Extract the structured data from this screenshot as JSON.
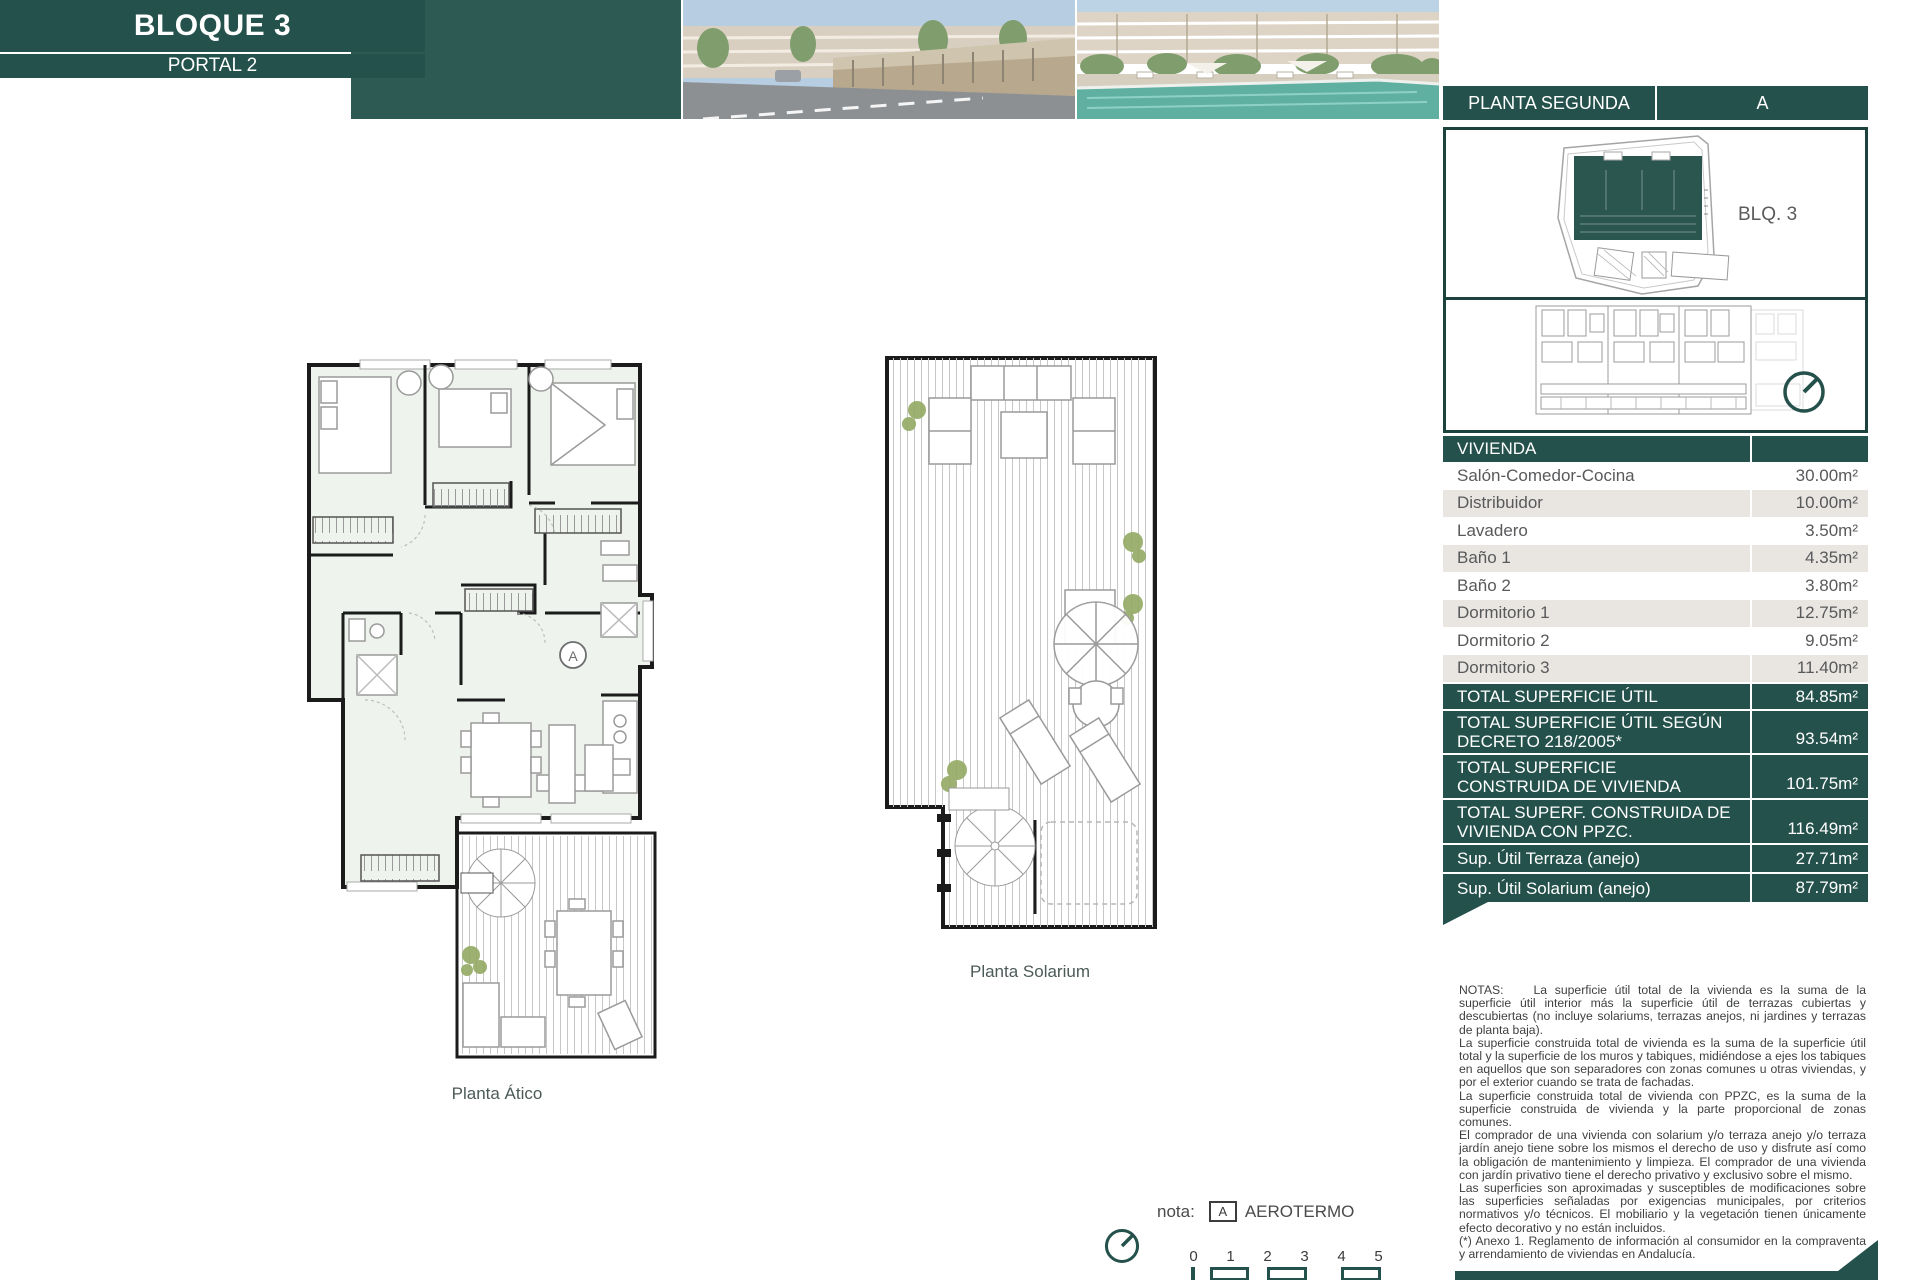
{
  "header": {
    "bloque": "BLOQUE 3",
    "portal": "PORTAL 2",
    "planta": "PLANTA SEGUNDA",
    "unit": "A"
  },
  "site_plan": {
    "block_label": "BLQ. 3"
  },
  "table": {
    "section_title": "VIVIENDA",
    "rows": [
      {
        "label": "Salón-Comedor-Cocina",
        "value": "30.00m²"
      },
      {
        "label": "Distribuidor",
        "value": "10.00m²"
      },
      {
        "label": "Lavadero",
        "value": "3.50m²"
      },
      {
        "label": "Baño 1",
        "value": "4.35m²"
      },
      {
        "label": "Baño 2",
        "value": "3.80m²"
      },
      {
        "label": "Dormitorio 1",
        "value": "12.75m²"
      },
      {
        "label": "Dormitorio 2",
        "value": "9.05m²"
      },
      {
        "label": "Dormitorio 3",
        "value": "11.40m²"
      }
    ],
    "totals": [
      {
        "label": "TOTAL SUPERFICIE ÚTIL",
        "value": "84.85m²"
      },
      {
        "label": "TOTAL SUPERFICIE ÚTIL SEGÚN\nDECRETO 218/2005*",
        "value": "93.54m²"
      },
      {
        "label": "TOTAL SUPERFICIE\nCONSTRUIDA DE VIVIENDA",
        "value": "101.75m²"
      },
      {
        "label": "TOTAL SUPERF. CONSTRUIDA DE\nVIVIENDA CON PPZC.",
        "value": "116.49m²"
      },
      {
        "label": "Sup. Útil Terraza (anejo)",
        "value": "27.71m²"
      },
      {
        "label": "Sup. Útil Solarium (anejo)",
        "value": "87.79m²"
      }
    ]
  },
  "plans": {
    "atico_label": "Planta Ático",
    "solarium_label": "Planta Solarium",
    "marker": "A"
  },
  "legend": {
    "nota_label": "nota:",
    "marker": "A",
    "marker_text": "AEROTERMO"
  },
  "scale_bar": {
    "ticks": [
      "0",
      "1",
      "2",
      "3",
      "4",
      "5"
    ]
  },
  "notes": {
    "heading": "NOTAS:",
    "paragraphs": [
      "La superficie útil total de la vivienda es la suma de la superficie útil interior más la superficie útil de terrazas cubiertas y descubiertas (no incluye solariums, terrazas anejos, ni jardines y terrazas de planta baja).",
      "La superficie construida total de vivienda es la suma de la superficie útil total y la superficie de los muros y tabiques, midiéndose a ejes los tabiques en aquellos que son separadores con zonas comunes u otras viviendas, y por el exterior cuando se trata de fachadas.",
      "La superficie construida total de vivienda con PPZC, es la suma de la superficie construida de vivienda y la parte proporcional de zonas comunes.",
      "El comprador de una vivienda con solarium y/o terraza anejo y/o terraza jardín anejo tiene sobre los mismos el derecho de uso y disfrute así como la obligación de mantenimiento y limpieza. El comprador de una vivienda con jardín privativo tiene el derecho privativo y exclusivo sobre el mismo.",
      "Las superficies son aproximadas y susceptibles de modificaciones sobre las superficies señaladas por exigencias municipales, por criterios normativos y/o técnicos. El mobiliario y la vegetación tienen únicamente efecto decorativo y no están incluidos.",
      "(*) Anexo 1. Reglamento de información al consumidor en la compraventa y arrendamiento de viviendas en Andalucía."
    ]
  },
  "colors": {
    "teal": "#24514b",
    "strip_teal": "#2d5a53",
    "row_stripe": "#e9e6e2",
    "plan_fill": "#eef4ed",
    "plant_green": "#93aa63",
    "pool": "#5fb0a1"
  }
}
